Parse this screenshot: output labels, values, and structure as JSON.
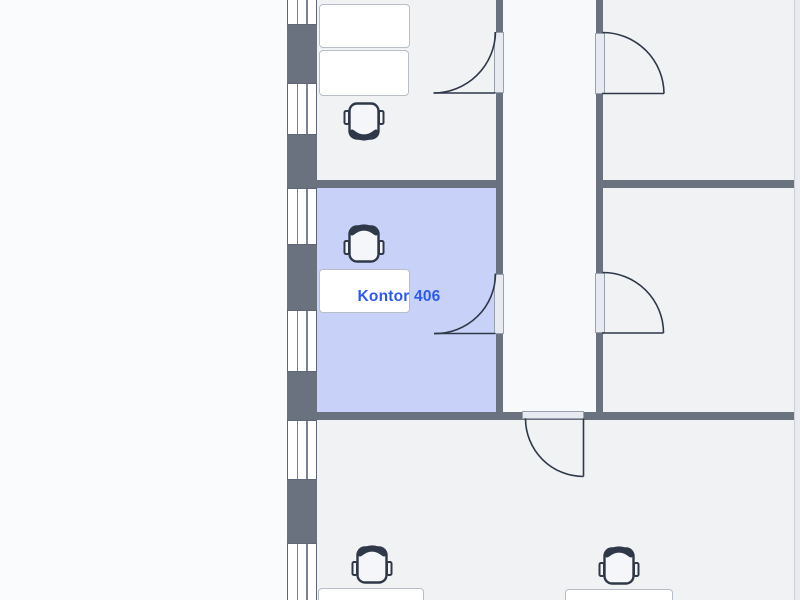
{
  "app": {
    "view": "floorplan"
  },
  "selected_room": {
    "label": "Kontor 406"
  },
  "floorplan": {
    "label": {
      "text": "Kontor 406",
      "cx": 399,
      "cy": 297
    },
    "colors": {
      "outside": "#fafbfc",
      "room": "#f0f2f4",
      "corridor": "#f8f9fb",
      "highlight": "#c8d2f8",
      "wall": "#6a7280",
      "outline": "#2f3848",
      "label_text": "#2b5af0",
      "desk_fill": "#ffffff",
      "desk_border": "#b8bec8",
      "chair_fill": "#f4f6f9",
      "window_fill": "#ffffff",
      "right_strip": "#e9ebf1",
      "right_strip_border": "#ccd0da"
    },
    "rooms": [
      {
        "id": "room-top-left",
        "x": 316,
        "y": 0,
        "w": 180,
        "h": 180,
        "fill": "room"
      },
      {
        "id": "corridor",
        "x": 502,
        "y": 0,
        "w": 94,
        "h": 412,
        "fill": "corridor"
      },
      {
        "id": "room-top-right",
        "x": 602,
        "y": 0,
        "w": 192,
        "h": 180,
        "fill": "room"
      },
      {
        "id": "room-kontor-406",
        "x": 316,
        "y": 188,
        "w": 180,
        "h": 224,
        "fill": "highlight"
      },
      {
        "id": "room-mid-right",
        "x": 602,
        "y": 188,
        "w": 192,
        "h": 224,
        "fill": "room"
      },
      {
        "id": "room-bottom",
        "x": 316,
        "y": 419,
        "w": 478,
        "h": 181,
        "fill": "room"
      }
    ],
    "walls": [
      {
        "id": "wall-left-exterior",
        "x": 287,
        "y": 0,
        "w": 29.5,
        "h": 600
      },
      {
        "id": "wall-corridor-left",
        "x": 495.5,
        "y": 0,
        "w": 7,
        "h": 419
      },
      {
        "id": "wall-corridor-right",
        "x": 595.5,
        "y": 0,
        "w": 7.5,
        "h": 419
      },
      {
        "id": "wall-mid-left",
        "x": 287,
        "y": 179.5,
        "w": 215.5,
        "h": 8.5
      },
      {
        "id": "wall-mid-right",
        "x": 595.5,
        "y": 179.5,
        "w": 198.5,
        "h": 8.5
      },
      {
        "id": "wall-bottom",
        "x": 287,
        "y": 411.5,
        "w": 507,
        "h": 8
      }
    ],
    "right_strip": {
      "x": 794,
      "y": 0,
      "w": 6,
      "h": 600
    },
    "windows": [
      {
        "x": 286.5,
        "y": -6,
        "w": 30.5,
        "h": 31
      },
      {
        "x": 286.5,
        "y": 83,
        "w": 30.5,
        "h": 52
      },
      {
        "x": 286.5,
        "y": 188,
        "w": 30.5,
        "h": 57
      },
      {
        "x": 286.5,
        "y": 310,
        "w": 30.5,
        "h": 62
      },
      {
        "x": 286.5,
        "y": 420,
        "w": 30.5,
        "h": 60
      },
      {
        "x": 286.5,
        "y": 543,
        "w": 30.5,
        "h": 60
      }
    ],
    "door_openings": [
      {
        "x": 494,
        "y": 32,
        "w": 10,
        "h": 61
      },
      {
        "x": 594.5,
        "y": 32.5,
        "w": 10,
        "h": 61
      },
      {
        "x": 494,
        "y": 273.5,
        "w": 10,
        "h": 60.5
      },
      {
        "x": 594.5,
        "y": 272.5,
        "w": 10,
        "h": 60.5
      },
      {
        "x": 521.5,
        "y": 410.5,
        "w": 62.5,
        "h": 8.5
      }
    ],
    "door_swings": [
      {
        "leaf": "M495.5 93 H433.5",
        "arc": "M433.5 93 A62 62 0 0 0 495.5 32"
      },
      {
        "leaf": "M602 93.5 H664",
        "arc": "M664 93.5 A61.5 61.5 0 0 0 602.5 32.5"
      },
      {
        "leaf": "M495.5 333.5 H434",
        "arc": "M434 333.5 A60 60 0 0 0 495.5 273.5"
      },
      {
        "leaf": "M602 333 H663.5",
        "arc": "M663.5 333 A60.5 60.5 0 0 0 602.5 272.5"
      },
      {
        "leaf": "M583.5 418.5 V476.5",
        "arc": "M583.5 476.5 A58 58 0 0 1 525.5 418.5"
      }
    ],
    "desks": [
      {
        "x": 319,
        "y": 4,
        "w": 91,
        "h": 44
      },
      {
        "x": 319,
        "y": 50,
        "w": 90,
        "h": 46
      },
      {
        "x": 318.5,
        "y": 269,
        "w": 91.5,
        "h": 44
      },
      {
        "x": 318,
        "y": 588,
        "w": 106,
        "h": 40
      },
      {
        "x": 565,
        "y": 589,
        "w": 108,
        "h": 40
      }
    ],
    "chairs": [
      {
        "cx": 364,
        "cy": 121,
        "rot": 180
      },
      {
        "cx": 364,
        "cy": 244,
        "rot": 0
      },
      {
        "cx": 372,
        "cy": 565,
        "rot": 0
      },
      {
        "cx": 619,
        "cy": 566,
        "rot": 0
      }
    ]
  }
}
